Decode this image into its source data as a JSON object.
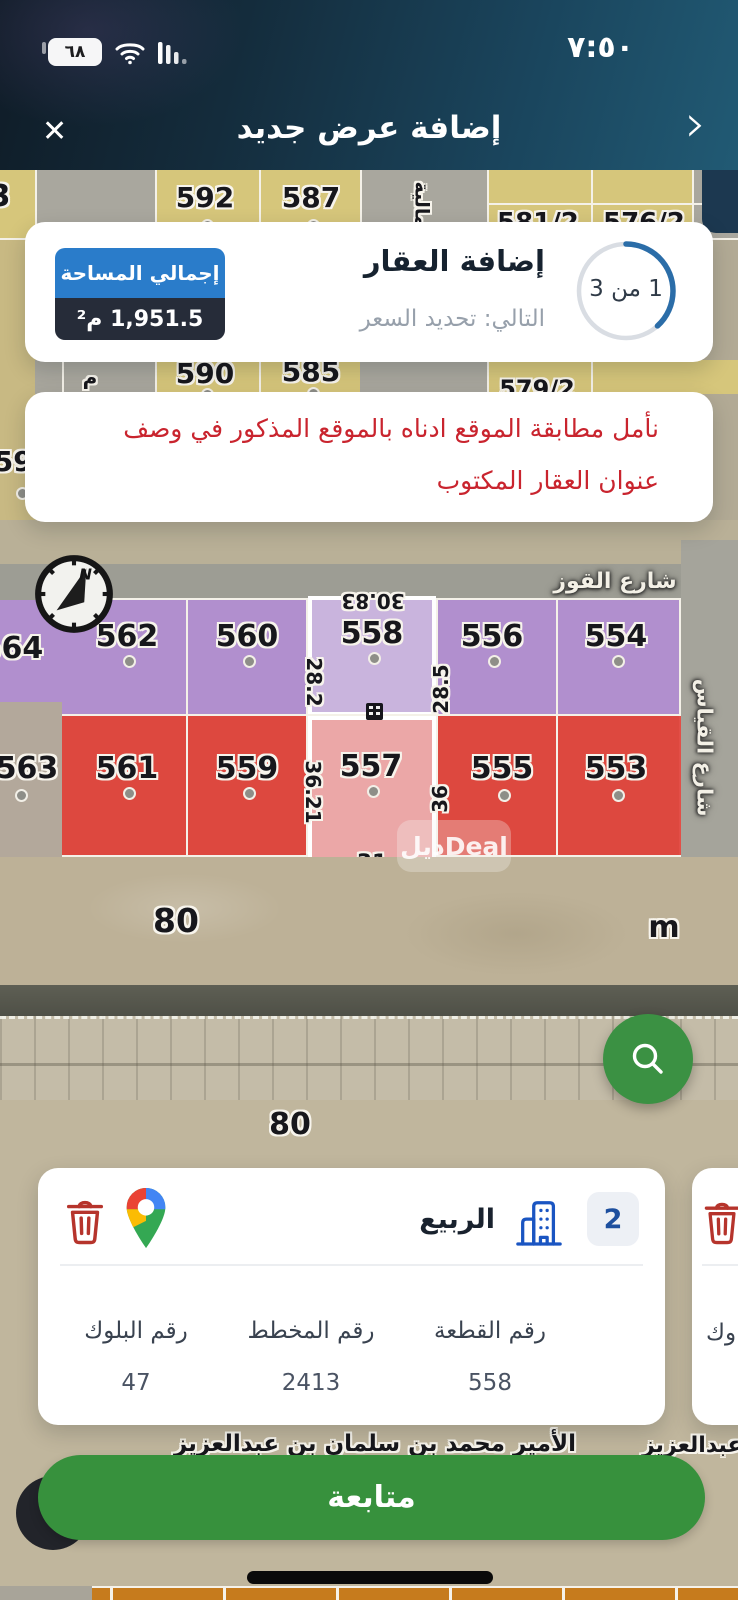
{
  "colors": {
    "header_gradient_start": "#0f1c27",
    "header_gradient_end": "#215a74",
    "accent_blue": "#2a7cca",
    "badge_dark_navy": "#262c39",
    "progress_blue": "#2b6da8",
    "notice_red": "#c9242e",
    "map_tan": "#b1a78e",
    "parcel_yellow": "#d6c67b",
    "parcel_purple": "#b08dd3",
    "parcel_purple_selected": "#c9b4dd",
    "parcel_red": "#e14038",
    "parcel_red_selected": "#eba7a7",
    "fab_green": "#3b9143",
    "button_green": "#37913d",
    "trash_red": "#b6342c",
    "building_blue": "#1a55c2",
    "chip_number_blue": "#1d4f9e"
  },
  "status_bar": {
    "time": "٧:٥٠",
    "battery_percent": "٦٨"
  },
  "header": {
    "title": "إضافة عرض جديد",
    "close_glyph": "✕",
    "back_glyph": "›"
  },
  "wizard_card": {
    "title": "إضافة العقار",
    "subtitle": "التالي: تحديد السعر",
    "step_label": "1 من 3",
    "area_badge_label": "إجمالي المساحة",
    "area_badge_value": "1,951.5 م²"
  },
  "notice_card": {
    "line1": "نأمل مطابقة الموقع ادناه بالموقع المذكور في وصف",
    "line2": "عنوان العقار المكتوب"
  },
  "map": {
    "compass_n": "N",
    "top_row": {
      "p0": "3",
      "p1": "592",
      "p2": "587",
      "p3": "مالية",
      "p4": "581/2",
      "p5": "576/2"
    },
    "mid_row": {
      "p0": "م",
      "p1": "590",
      "p2": "585",
      "p3": "579/2"
    },
    "left_parcel": "595",
    "street_top": "شارع القوز",
    "street_right": "شارع القياس",
    "purple_row": [
      "564",
      "562",
      "560",
      "558",
      "556",
      "554"
    ],
    "red_row": [
      "563",
      "561",
      "559",
      "557",
      "555",
      "553"
    ],
    "dimensions": {
      "top": "30.83",
      "upper_left": "28.2",
      "upper_right": "28.5",
      "lower_left": "36.21",
      "lower_right": "36",
      "bottom": "31"
    },
    "road_width_label_1": "80",
    "road_width_label_2": "80",
    "meters_label": "m",
    "street_bottom": "الأمير محمد بن سلمان بن عبدالعزيز",
    "street_bottom_fragment": "بن عبدالعزيز",
    "watermark": "ديلDeal"
  },
  "parcel_card": {
    "district_name": "الربيع",
    "unit_count": "2",
    "fields": [
      {
        "label": "رقم القطعة",
        "value": "558"
      },
      {
        "label": "رقم المخطط",
        "value": "2413"
      },
      {
        "label": "رقم البلوك",
        "value": "47"
      }
    ]
  },
  "parcel_card_partial": {
    "label_fragment": "وك"
  },
  "footer": {
    "continue_label": "متابعة"
  }
}
